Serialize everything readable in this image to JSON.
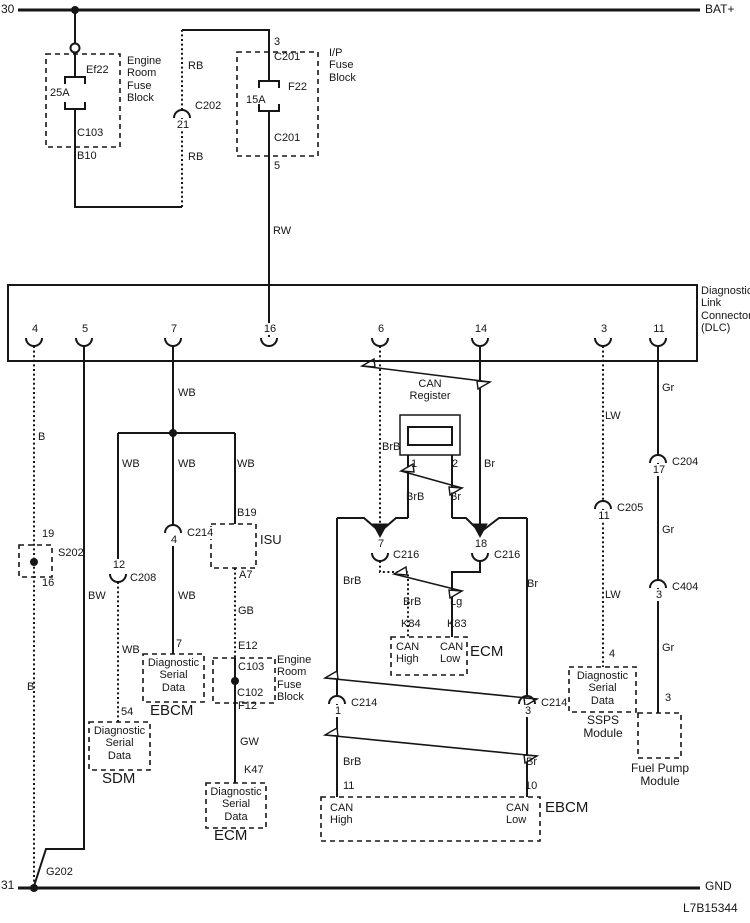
{
  "title": "Diagnostic Link Connector (DLC) wiring schematic",
  "doc_number": "L7B15344",
  "colors": {
    "ink": "#161616",
    "background": "#ffffff"
  },
  "diagram": {
    "labels": [
      {
        "id": "terminal-30",
        "text": "30",
        "x": 1,
        "y": 3,
        "size": 12
      },
      {
        "id": "bat-plus",
        "text": "BAT+",
        "x": 705,
        "y": 3,
        "size": 12
      },
      {
        "id": "fuse-ef22-name",
        "text": "Ef22",
        "x": 86,
        "y": 64
      },
      {
        "id": "fuse-ef22-rating",
        "text": "25A",
        "x": 50,
        "y": 87
      },
      {
        "id": "conn-c103-top",
        "text": "C103",
        "x": 77,
        "y": 127
      },
      {
        "id": "pin-b10",
        "text": "B10",
        "x": 77,
        "y": 150
      },
      {
        "id": "engine-room-fuse-block-1",
        "text": "Engine\nRoom\nFuse\nBlock",
        "x": 127,
        "y": 55
      },
      {
        "id": "wire-rb-upper",
        "text": "RB",
        "x": 188,
        "y": 60
      },
      {
        "id": "wire-rb-lower",
        "text": "RB",
        "x": 188,
        "y": 151
      },
      {
        "id": "pin-3-ipfb",
        "text": "3",
        "x": 274,
        "y": 36
      },
      {
        "id": "conn-c201-top",
        "text": "C201",
        "x": 274,
        "y": 51
      },
      {
        "id": "fuse-f22-name",
        "text": "F22",
        "x": 288,
        "y": 81
      },
      {
        "id": "fuse-f22-rating",
        "text": "15A",
        "x": 246,
        "y": 94
      },
      {
        "id": "conn-c201-bottom",
        "text": "C201",
        "x": 274,
        "y": 132
      },
      {
        "id": "pin-5-ipfb",
        "text": "5",
        "x": 274,
        "y": 160
      },
      {
        "id": "ip-fuse-block",
        "text": "I/P\nFuse\nBlock",
        "x": 329,
        "y": 47
      },
      {
        "id": "wire-rw",
        "text": "RW",
        "x": 273,
        "y": 225
      },
      {
        "id": "dlc-title",
        "text": "Diagnostic\nLink\nConnector\n(DLC)",
        "x": 701,
        "y": 285
      },
      {
        "id": "wire-wb-1",
        "text": "WB",
        "x": 178,
        "y": 387
      },
      {
        "id": "wire-b-1",
        "text": "B",
        "x": 38,
        "y": 431
      },
      {
        "id": "wire-wb-2",
        "text": "WB",
        "x": 122,
        "y": 458
      },
      {
        "id": "wire-wb-3",
        "text": "WB",
        "x": 178,
        "y": 458
      },
      {
        "id": "wire-wb-4",
        "text": "WB",
        "x": 237,
        "y": 458
      },
      {
        "id": "pin-b19",
        "text": "B19",
        "x": 237,
        "y": 507
      },
      {
        "id": "module-isu",
        "text": "ISU",
        "x": 260,
        "y": 533,
        "size": 13
      },
      {
        "id": "pin-a7",
        "text": "A7",
        "x": 239,
        "y": 569
      },
      {
        "id": "wire-gb",
        "text": "GB",
        "x": 238,
        "y": 605
      },
      {
        "id": "wire-wb-5",
        "text": "WB",
        "x": 178,
        "y": 590
      },
      {
        "id": "wire-bw",
        "text": "BW",
        "x": 88,
        "y": 590
      },
      {
        "id": "pin-19",
        "text": "19",
        "x": 42,
        "y": 528
      },
      {
        "id": "splice-s202",
        "text": "S202",
        "x": 58,
        "y": 547
      },
      {
        "id": "pin-16-splice",
        "text": "16",
        "x": 42,
        "y": 577
      },
      {
        "id": "wire-b-2",
        "text": "B",
        "x": 27,
        "y": 681
      },
      {
        "id": "pin-7-ebcm",
        "text": "7",
        "x": 176,
        "y": 638
      },
      {
        "id": "wire-wb-6",
        "text": "WB",
        "x": 122,
        "y": 644
      },
      {
        "id": "pin-54",
        "text": "54",
        "x": 121,
        "y": 706
      },
      {
        "id": "dsd-ebcm",
        "text": "Diagnostic\nSerial\nData",
        "x": 143,
        "y": 657,
        "w": 61,
        "align": "center"
      },
      {
        "id": "module-ebcm-1",
        "text": "EBCM",
        "x": 150,
        "y": 703,
        "size": 15
      },
      {
        "id": "dsd-sdm",
        "text": "Diagnostic\nSerial\nData",
        "x": 89,
        "y": 725,
        "w": 61,
        "align": "center"
      },
      {
        "id": "module-sdm",
        "text": "SDM",
        "x": 102,
        "y": 771,
        "size": 15
      },
      {
        "id": "pin-e12",
        "text": "E12",
        "x": 238,
        "y": 640
      },
      {
        "id": "conn-c103",
        "text": "C103",
        "x": 238,
        "y": 661
      },
      {
        "id": "conn-c102",
        "text": "C102",
        "x": 237,
        "y": 687
      },
      {
        "id": "engine-room-fuse-block-2",
        "text": "Engine\nRoom\nFuse\nBlock",
        "x": 277,
        "y": 654
      },
      {
        "id": "pin-f12",
        "text": "F12",
        "x": 238,
        "y": 700
      },
      {
        "id": "wire-gw",
        "text": "GW",
        "x": 240,
        "y": 736
      },
      {
        "id": "pin-k47",
        "text": "K47",
        "x": 244,
        "y": 764
      },
      {
        "id": "dsd-ecm",
        "text": "Diagnostic\nSerial\nData",
        "x": 206,
        "y": 786,
        "w": 60,
        "align": "center"
      },
      {
        "id": "module-ecm-1",
        "text": "ECM",
        "x": 214,
        "y": 828,
        "size": 15
      },
      {
        "id": "wire-brb-1",
        "text": "BrB",
        "x": 382,
        "y": 441
      },
      {
        "id": "wire-br-1",
        "text": "Br",
        "x": 484,
        "y": 458
      },
      {
        "id": "can-register",
        "text": "CAN\nRegister",
        "x": 398,
        "y": 378,
        "w": 64,
        "align": "center"
      },
      {
        "id": "reg-pin-1",
        "text": "1",
        "x": 411,
        "y": 458
      },
      {
        "id": "reg-pin-2",
        "text": "2",
        "x": 452,
        "y": 458
      },
      {
        "id": "wire-brb-2",
        "text": "BrB",
        "x": 406,
        "y": 491
      },
      {
        "id": "wire-br-2",
        "text": "Br",
        "x": 450,
        "y": 491
      },
      {
        "id": "wire-brb-3",
        "text": "BrB",
        "x": 343,
        "y": 575
      },
      {
        "id": "wire-br-3",
        "text": "Br",
        "x": 527,
        "y": 578
      },
      {
        "id": "wire-brb-4",
        "text": "BrB",
        "x": 403,
        "y": 596
      },
      {
        "id": "wire-lg",
        "text": "Lg",
        "x": 450,
        "y": 596
      },
      {
        "id": "pin-k84",
        "text": "K84",
        "x": 401,
        "y": 618
      },
      {
        "id": "pin-k83",
        "text": "K83",
        "x": 447,
        "y": 618
      },
      {
        "id": "ecm-can-high",
        "text": "CAN\nHigh",
        "x": 396,
        "y": 641
      },
      {
        "id": "ecm-can-low",
        "text": "CAN\nLow",
        "x": 440,
        "y": 641
      },
      {
        "id": "module-ecm-2",
        "text": "ECM",
        "x": 470,
        "y": 644,
        "size": 15
      },
      {
        "id": "wire-brb-5",
        "text": "BrB",
        "x": 343,
        "y": 756
      },
      {
        "id": "wire-br-4",
        "text": "Br",
        "x": 526,
        "y": 756
      },
      {
        "id": "pin-11-ebcm",
        "text": "11",
        "x": 343,
        "y": 780
      },
      {
        "id": "pin-10-ebcm",
        "text": "10",
        "x": 525,
        "y": 780
      },
      {
        "id": "ebcm-can-high",
        "text": "CAN\nHigh",
        "x": 330,
        "y": 802
      },
      {
        "id": "ebcm-can-low",
        "text": "CAN\nLow",
        "x": 506,
        "y": 802
      },
      {
        "id": "module-ebcm-2",
        "text": "EBCM",
        "x": 545,
        "y": 800,
        "size": 15
      },
      {
        "id": "wire-lw-1",
        "text": "LW",
        "x": 605,
        "y": 410
      },
      {
        "id": "wire-lw-2",
        "text": "LW",
        "x": 605,
        "y": 589
      },
      {
        "id": "pin-4-ssps",
        "text": "4",
        "x": 609,
        "y": 648
      },
      {
        "id": "dsd-ssps",
        "text": "Diagnostic\nSerial\nData",
        "x": 569,
        "y": 670,
        "w": 67,
        "align": "center"
      },
      {
        "id": "module-ssps",
        "text": "SSPS\nModule",
        "x": 573,
        "y": 714,
        "w": 60,
        "align": "center",
        "size": 12
      },
      {
        "id": "wire-gr-1",
        "text": "Gr",
        "x": 662,
        "y": 382
      },
      {
        "id": "wire-gr-2",
        "text": "Gr",
        "x": 662,
        "y": 524
      },
      {
        "id": "wire-gr-3",
        "text": "Gr",
        "x": 662,
        "y": 642
      },
      {
        "id": "pin-3-fuel",
        "text": "3",
        "x": 665,
        "y": 692
      },
      {
        "id": "module-fuel-pump",
        "text": "Fuel Pump\nModule",
        "x": 618,
        "y": 762,
        "w": 84,
        "align": "center",
        "size": 12
      },
      {
        "id": "terminal-31",
        "text": "31",
        "x": 1,
        "y": 879,
        "size": 12
      },
      {
        "id": "ground-g202",
        "text": "G202",
        "x": 46,
        "y": 866
      },
      {
        "id": "gnd",
        "text": "GND",
        "x": 705,
        "y": 880,
        "size": 12
      },
      {
        "id": "doc-number",
        "text": "L7B15344",
        "x": 683,
        "y": 902,
        "size": 12
      }
    ],
    "connectors": [
      {
        "id": "dlc-pin-4",
        "cx": 34,
        "cy": 338,
        "style": "cup",
        "num": "4"
      },
      {
        "id": "dlc-pin-5",
        "cx": 84,
        "cy": 338,
        "style": "cup",
        "num": "5"
      },
      {
        "id": "dlc-pin-7",
        "cx": 173,
        "cy": 338,
        "style": "cup",
        "num": "7"
      },
      {
        "id": "dlc-pin-16",
        "cx": 269,
        "cy": 338,
        "style": "cup",
        "num": "16"
      },
      {
        "id": "dlc-pin-6",
        "cx": 380,
        "cy": 338,
        "style": "cup",
        "num": "6"
      },
      {
        "id": "dlc-pin-14",
        "cx": 480,
        "cy": 338,
        "style": "cup",
        "num": "14"
      },
      {
        "id": "dlc-pin-3",
        "cx": 603,
        "cy": 338,
        "style": "cup",
        "num": "3"
      },
      {
        "id": "dlc-pin-11",
        "cx": 658,
        "cy": 338,
        "style": "cup",
        "num": "11"
      },
      {
        "id": "conn-c202",
        "cx": 182,
        "cy": 118,
        "style": "cap",
        "num": "21",
        "label": "C202",
        "lx": 194,
        "ly": 100
      },
      {
        "id": "conn-c208",
        "cx": 118,
        "cy": 574,
        "style": "cup",
        "num": "12",
        "label": "C208",
        "lx": 129,
        "ly": 572
      },
      {
        "id": "conn-c214-mid",
        "cx": 173,
        "cy": 533,
        "style": "cap",
        "num": "4",
        "label": "C214",
        "lx": 186,
        "ly": 527
      },
      {
        "id": "conn-c216-left",
        "cx": 380,
        "cy": 553,
        "style": "cup",
        "num": "7",
        "label": "C216",
        "lx": 392,
        "ly": 549
      },
      {
        "id": "conn-c216-right",
        "cx": 480,
        "cy": 553,
        "style": "cup",
        "num": "18",
        "label": "C216",
        "lx": 493,
        "ly": 549
      },
      {
        "id": "conn-c214-bottom-left",
        "cx": 337,
        "cy": 704,
        "style": "cap",
        "num": "1",
        "label": "C214",
        "lx": 350,
        "ly": 697
      },
      {
        "id": "conn-c214-bottom-right",
        "cx": 527,
        "cy": 704,
        "style": "cap",
        "num": "3",
        "label": "C214",
        "lx": 540,
        "ly": 697
      },
      {
        "id": "conn-c205",
        "cx": 603,
        "cy": 509,
        "style": "cap",
        "num": "11",
        "label": "C205",
        "lx": 616,
        "ly": 502
      },
      {
        "id": "conn-c204",
        "cx": 658,
        "cy": 463,
        "style": "cap",
        "num": "17",
        "label": "C204",
        "lx": 671,
        "ly": 456
      },
      {
        "id": "conn-c404",
        "cx": 658,
        "cy": 588,
        "style": "cap",
        "num": "3",
        "label": "C404",
        "lx": 671,
        "ly": 581
      }
    ],
    "wires": [
      {
        "id": "bus-bat",
        "points": "18,10 700,10",
        "w": 3
      },
      {
        "id": "ef22-feed",
        "points": "75,10 75,43"
      },
      {
        "id": "ef22-in",
        "points": "75,53 75,77"
      },
      {
        "id": "ef22-out",
        "points": "75,109 75,207 182,207"
      },
      {
        "id": "rb-lower",
        "points": "182,207 182,118",
        "dotted": true
      },
      {
        "id": "rb-upper",
        "points": "182,110 182,30",
        "dotted": true
      },
      {
        "id": "ipfb-feed",
        "points": "182,30 269,30 269,81"
      },
      {
        "id": "rw-feed",
        "points": "269,111 269,337"
      },
      {
        "id": "ground-b",
        "points": "34,346 34,888",
        "dotted": true
      },
      {
        "id": "ground-bw",
        "points": "84,346 84,849 46,849 34,886"
      },
      {
        "id": "wb-main",
        "points": "173,346 173,433"
      },
      {
        "id": "wb-branch",
        "points": "118,433 235,433"
      },
      {
        "id": "wb-left",
        "points": "118,433 118,566"
      },
      {
        "id": "wb-left-2",
        "points": "118,582 118,722",
        "dotted": true
      },
      {
        "id": "wb-mid",
        "points": "173,433 173,525"
      },
      {
        "id": "wb-mid-2",
        "points": "173,541 173,654"
      },
      {
        "id": "wb-right",
        "points": "235,433 235,524"
      },
      {
        "id": "gb",
        "points": "235,568 235,658",
        "dotted": true
      },
      {
        "id": "erfb2-inner",
        "points": "235,658 235,702"
      },
      {
        "id": "gw",
        "points": "235,702 235,783"
      },
      {
        "id": "can-high-dlc",
        "points": "380,346 380,533",
        "dotted": true
      },
      {
        "id": "can-low-dlc",
        "points": "480,346 480,533"
      },
      {
        "id": "reg-leg-1",
        "points": "408,455 408,518"
      },
      {
        "id": "reg-leg-2",
        "points": "452,455 452,518"
      },
      {
        "id": "c216l-out",
        "points": "380,561 380,572 408,572 408,637",
        "dotted": true
      },
      {
        "id": "c216r-out",
        "points": "480,561 480,572 452,572 452,637"
      },
      {
        "id": "can-bus-left",
        "points": "337,518 337,696"
      },
      {
        "id": "can-bus-left-2",
        "points": "337,704 337,797"
      },
      {
        "id": "can-bus-right",
        "points": "527,518 527,696"
      },
      {
        "id": "can-bus-right-2",
        "points": "527,704 527,797"
      },
      {
        "id": "lw",
        "points": "603,346 603,501",
        "dotted": true
      },
      {
        "id": "lw-2",
        "points": "603,509 603,667",
        "dotted": true
      },
      {
        "id": "gr",
        "points": "658,346 658,455"
      },
      {
        "id": "gr-2",
        "points": "658,463 658,580"
      },
      {
        "id": "gr-3",
        "points": "658,588 658,713"
      },
      {
        "id": "bus-gnd",
        "points": "18,888 700,888",
        "w": 3
      }
    ],
    "funnels": [
      {
        "points": "337,518 364,518 379,531"
      },
      {
        "points": "408,518 396,518 381,531"
      },
      {
        "points": "452,518 466,518 479,531"
      },
      {
        "points": "527,518 499,518 482,531"
      }
    ],
    "arrow_tips": [
      {
        "points": "373,524 387,524 380,537"
      },
      {
        "points": "473,524 487,524 480,537"
      }
    ],
    "twists": [
      {
        "x1": 362,
        "y1": 366,
        "x2": 490,
        "y2": 382
      },
      {
        "x1": 401,
        "y1": 471,
        "x2": 462,
        "y2": 488
      },
      {
        "x1": 394,
        "y1": 574,
        "x2": 462,
        "y2": 591
      },
      {
        "x1": 325,
        "y1": 678,
        "x2": 537,
        "y2": 699
      },
      {
        "x1": 325,
        "y1": 735,
        "x2": 537,
        "y2": 756
      }
    ],
    "boxes": [
      {
        "id": "engine-room-fuse-block-1",
        "x": 46,
        "y": 54,
        "w": 74,
        "h": 93,
        "dashed": true
      },
      {
        "id": "ip-fuse-block",
        "x": 237,
        "y": 52,
        "w": 81,
        "h": 104,
        "dashed": true
      },
      {
        "id": "dlc-box",
        "x": 8,
        "y": 285,
        "w": 689,
        "h": 76,
        "dashed": false,
        "sw": 2
      },
      {
        "id": "s202-box",
        "x": 19,
        "y": 545,
        "w": 33,
        "h": 32,
        "dashed": true
      },
      {
        "id": "isu-box",
        "x": 211,
        "y": 524,
        "w": 45,
        "h": 44,
        "dashed": true
      },
      {
        "id": "can-register-outer",
        "x": 400,
        "y": 415,
        "w": 60,
        "h": 40,
        "dashed": false,
        "sw": 1.5
      },
      {
        "id": "can-register-resistor",
        "x": 408,
        "y": 427,
        "w": 44,
        "h": 18,
        "dashed": false,
        "sw": 2
      },
      {
        "id": "dsd-ebcm-box",
        "x": 143,
        "y": 654,
        "w": 61,
        "h": 48,
        "dashed": true
      },
      {
        "id": "dsd-sdm-box",
        "x": 89,
        "y": 722,
        "w": 61,
        "h": 48,
        "dashed": true
      },
      {
        "id": "engine-room-fuse-block-2",
        "x": 213,
        "y": 658,
        "w": 62,
        "h": 45,
        "dashed": true
      },
      {
        "id": "dsd-ecm-box",
        "x": 206,
        "y": 783,
        "w": 60,
        "h": 45,
        "dashed": true
      },
      {
        "id": "ecm-can-box",
        "x": 391,
        "y": 637,
        "w": 76,
        "h": 38,
        "dashed": true
      },
      {
        "id": "ebcm-can-box",
        "x": 321,
        "y": 797,
        "w": 219,
        "h": 44,
        "dashed": true
      },
      {
        "id": "dsd-ssps-box",
        "x": 569,
        "y": 667,
        "w": 67,
        "h": 45,
        "dashed": true
      },
      {
        "id": "fuel-pump-box",
        "x": 638,
        "y": 713,
        "w": 43,
        "h": 45,
        "dashed": true
      }
    ],
    "fuses": [
      {
        "id": "fuse-ef22",
        "cx": 75,
        "top": 77,
        "bottom": 109,
        "hw": 10
      },
      {
        "id": "fuse-f22",
        "cx": 269,
        "top": 81,
        "bottom": 111,
        "hw": 10
      }
    ],
    "dots": [
      {
        "x": 75,
        "y": 10
      },
      {
        "x": 173,
        "y": 433
      },
      {
        "x": 34,
        "y": 562
      },
      {
        "x": 235,
        "y": 681
      },
      {
        "x": 34,
        "y": 888
      }
    ],
    "open_circles": [
      {
        "x": 75,
        "y": 48
      }
    ]
  }
}
